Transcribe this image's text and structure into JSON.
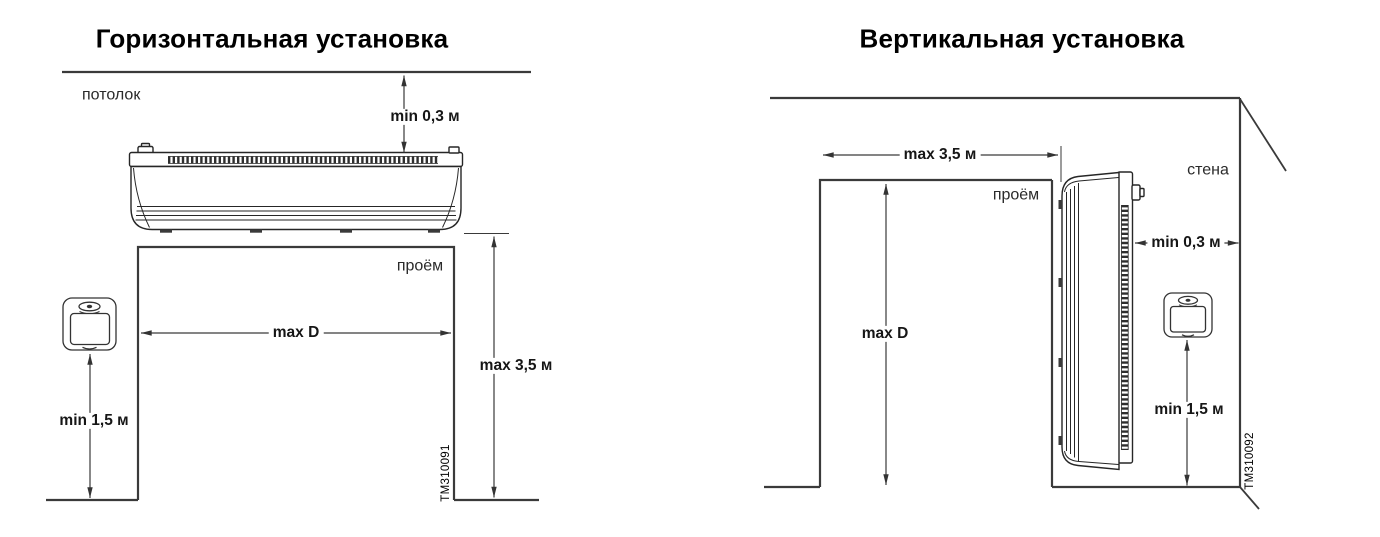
{
  "figure": {
    "background": "#ffffff",
    "line_color": "#3a3a3a",
    "text_color": "#161616"
  },
  "left_diagram": {
    "title": "Горизонтальная установка",
    "ceiling_label": "потолок",
    "opening_label": "проём",
    "figure_id": "TM310091",
    "device_icon": "air-curtain-horizontal",
    "controller_icon": "wall-controller",
    "dimensions": {
      "ceiling_clearance": "min 0,3 м",
      "opening_width": "max D",
      "max_mounting_height": "max 3,5 м",
      "controller_height": "min 1,5 м"
    }
  },
  "right_diagram": {
    "title": "Вертикальная установка",
    "opening_label": "проём",
    "wall_label": "стена",
    "figure_id": "TM310092",
    "device_icon": "air-curtain-vertical",
    "controller_icon": "wall-controller",
    "dimensions": {
      "max_opening_width": "max 3,5 м",
      "wall_clearance": "min 0,3 м",
      "opening_height": "max D",
      "controller_height": "min 1,5 м"
    }
  }
}
